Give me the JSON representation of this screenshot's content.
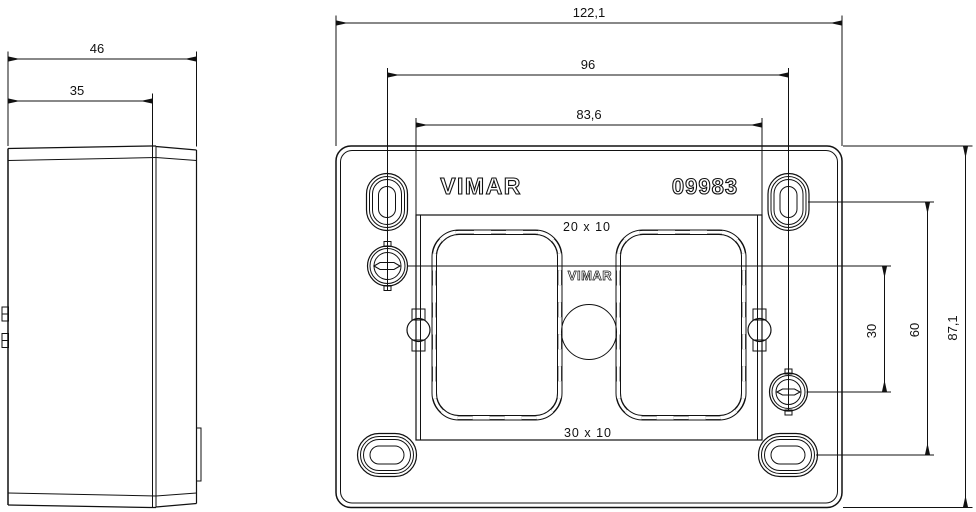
{
  "drawing": {
    "brand": "VIMAR",
    "product_code": "09983",
    "frame_brand": "VIMAR",
    "labels": {
      "knockout_top": "20 x 10",
      "knockout_bottom": "30 x 10"
    },
    "dims": {
      "side_depth_total": "46",
      "side_depth_body": "35",
      "width_total": "122,1",
      "width_screw_centers": "96",
      "width_claw_centers": "83,6",
      "height_screw_offset": "30",
      "height_slot_centers": "60",
      "height_total": "87,1"
    }
  }
}
